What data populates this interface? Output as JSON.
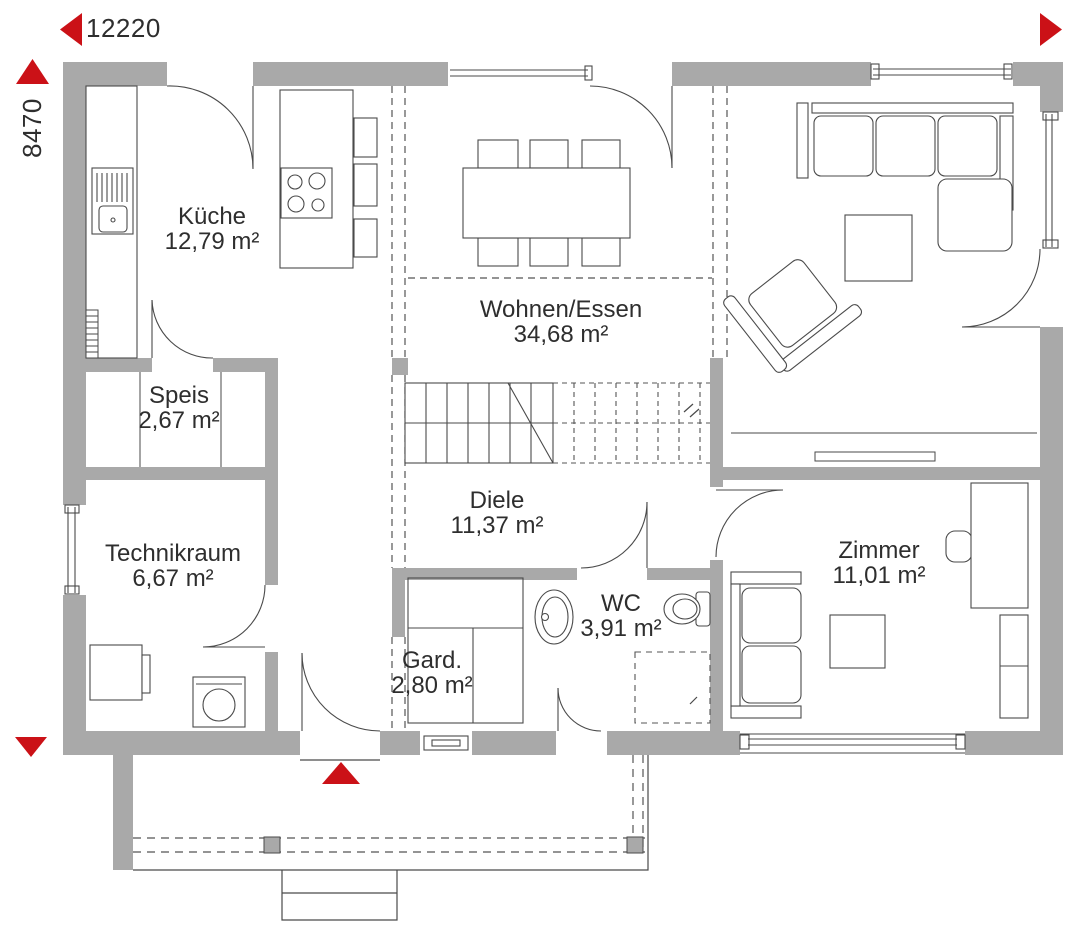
{
  "plan": {
    "dimension_width": "12220",
    "dimension_height": "8470",
    "rooms": {
      "kueche": {
        "name": "Küche",
        "area": "12,79 m²"
      },
      "wohnen_essen": {
        "name": "Wohnen/Essen",
        "area": "34,68 m²"
      },
      "speis": {
        "name": "Speis",
        "area": "2,67 m²"
      },
      "technikraum": {
        "name": "Technikraum",
        "area": "6,67 m²"
      },
      "diele": {
        "name": "Diele",
        "area": "11,37 m²"
      },
      "garderobe": {
        "name": "Gard.",
        "area": "2,80 m²"
      },
      "wc": {
        "name": "WC",
        "area": "3,91 m²"
      },
      "zimmer": {
        "name": "Zimmer",
        "area": "11,01 m²"
      }
    },
    "colors": {
      "wall": "#a9a9a9",
      "accent_red": "#cb1117",
      "line": "#4a4a4a",
      "text": "#2e2e2e"
    },
    "icons": {
      "dimension_arrow_left": "◀",
      "dimension_arrow_up": "▲",
      "dimension_arrow_right": "▶",
      "dimension_arrow_down": "▼",
      "entrance_arrow": "▲"
    }
  }
}
